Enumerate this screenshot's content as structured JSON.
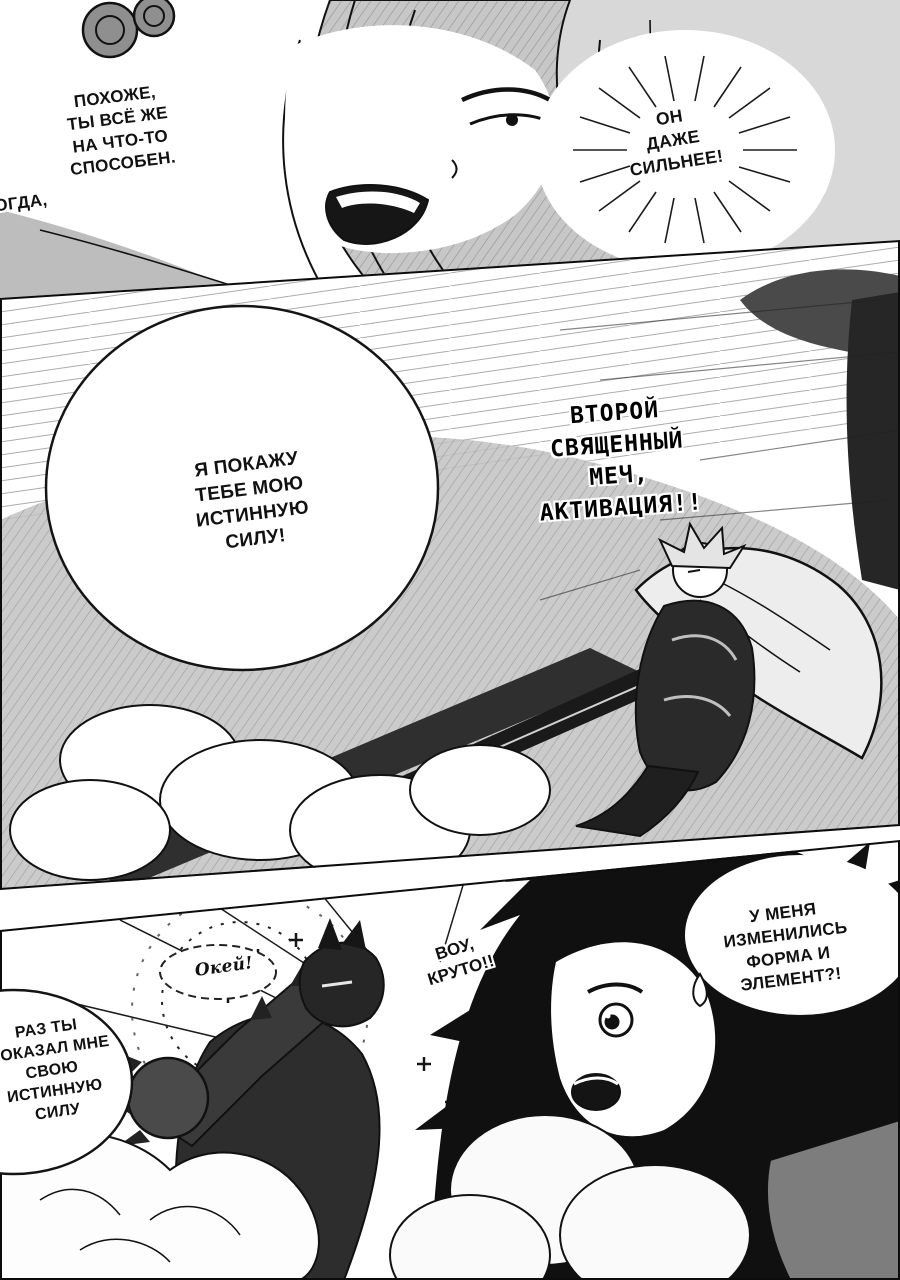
{
  "page": {
    "kind": "manga-page",
    "ink_color": "#111111",
    "paper_color": "#ffffff",
    "tone_color": "#c7c7c7"
  },
  "panel_top": {
    "bubble_left_text": "ПОХОЖЕ,\nТЫ ВСЁ ЖЕ\nНА ЧТО-ТО\nСПОСОБЕН.",
    "caption_left_text": "ТОГДА,",
    "burst_right_text": "ОН\nДАЖЕ\nСИЛЬНЕЕ!"
  },
  "panel_middle": {
    "bubble_text": "Я ПОКАЖУ\nТЕБЕ МОЮ\nИСТИННУЮ\nСИЛУ!",
    "shout_text": "ВТОРОЙ\nСВЯЩЕННЫЙ\nМЕЧ,\nАКТИВАЦИЯ!!"
  },
  "panel_bottom": {
    "okay_text": "Окей!",
    "wow_text": "ВОУ,\nКРУТО!!",
    "right_bubble_text": "У МЕНЯ\nИЗМЕНИЛИСЬ\nФОРМА И\nЭЛЕМЕНТ?!",
    "left_bubble_text": "РАЗ ТЫ\nПОКАЗАЛ МНЕ\nСВОЮ\nИСТИННУЮ\nСИЛУ"
  }
}
